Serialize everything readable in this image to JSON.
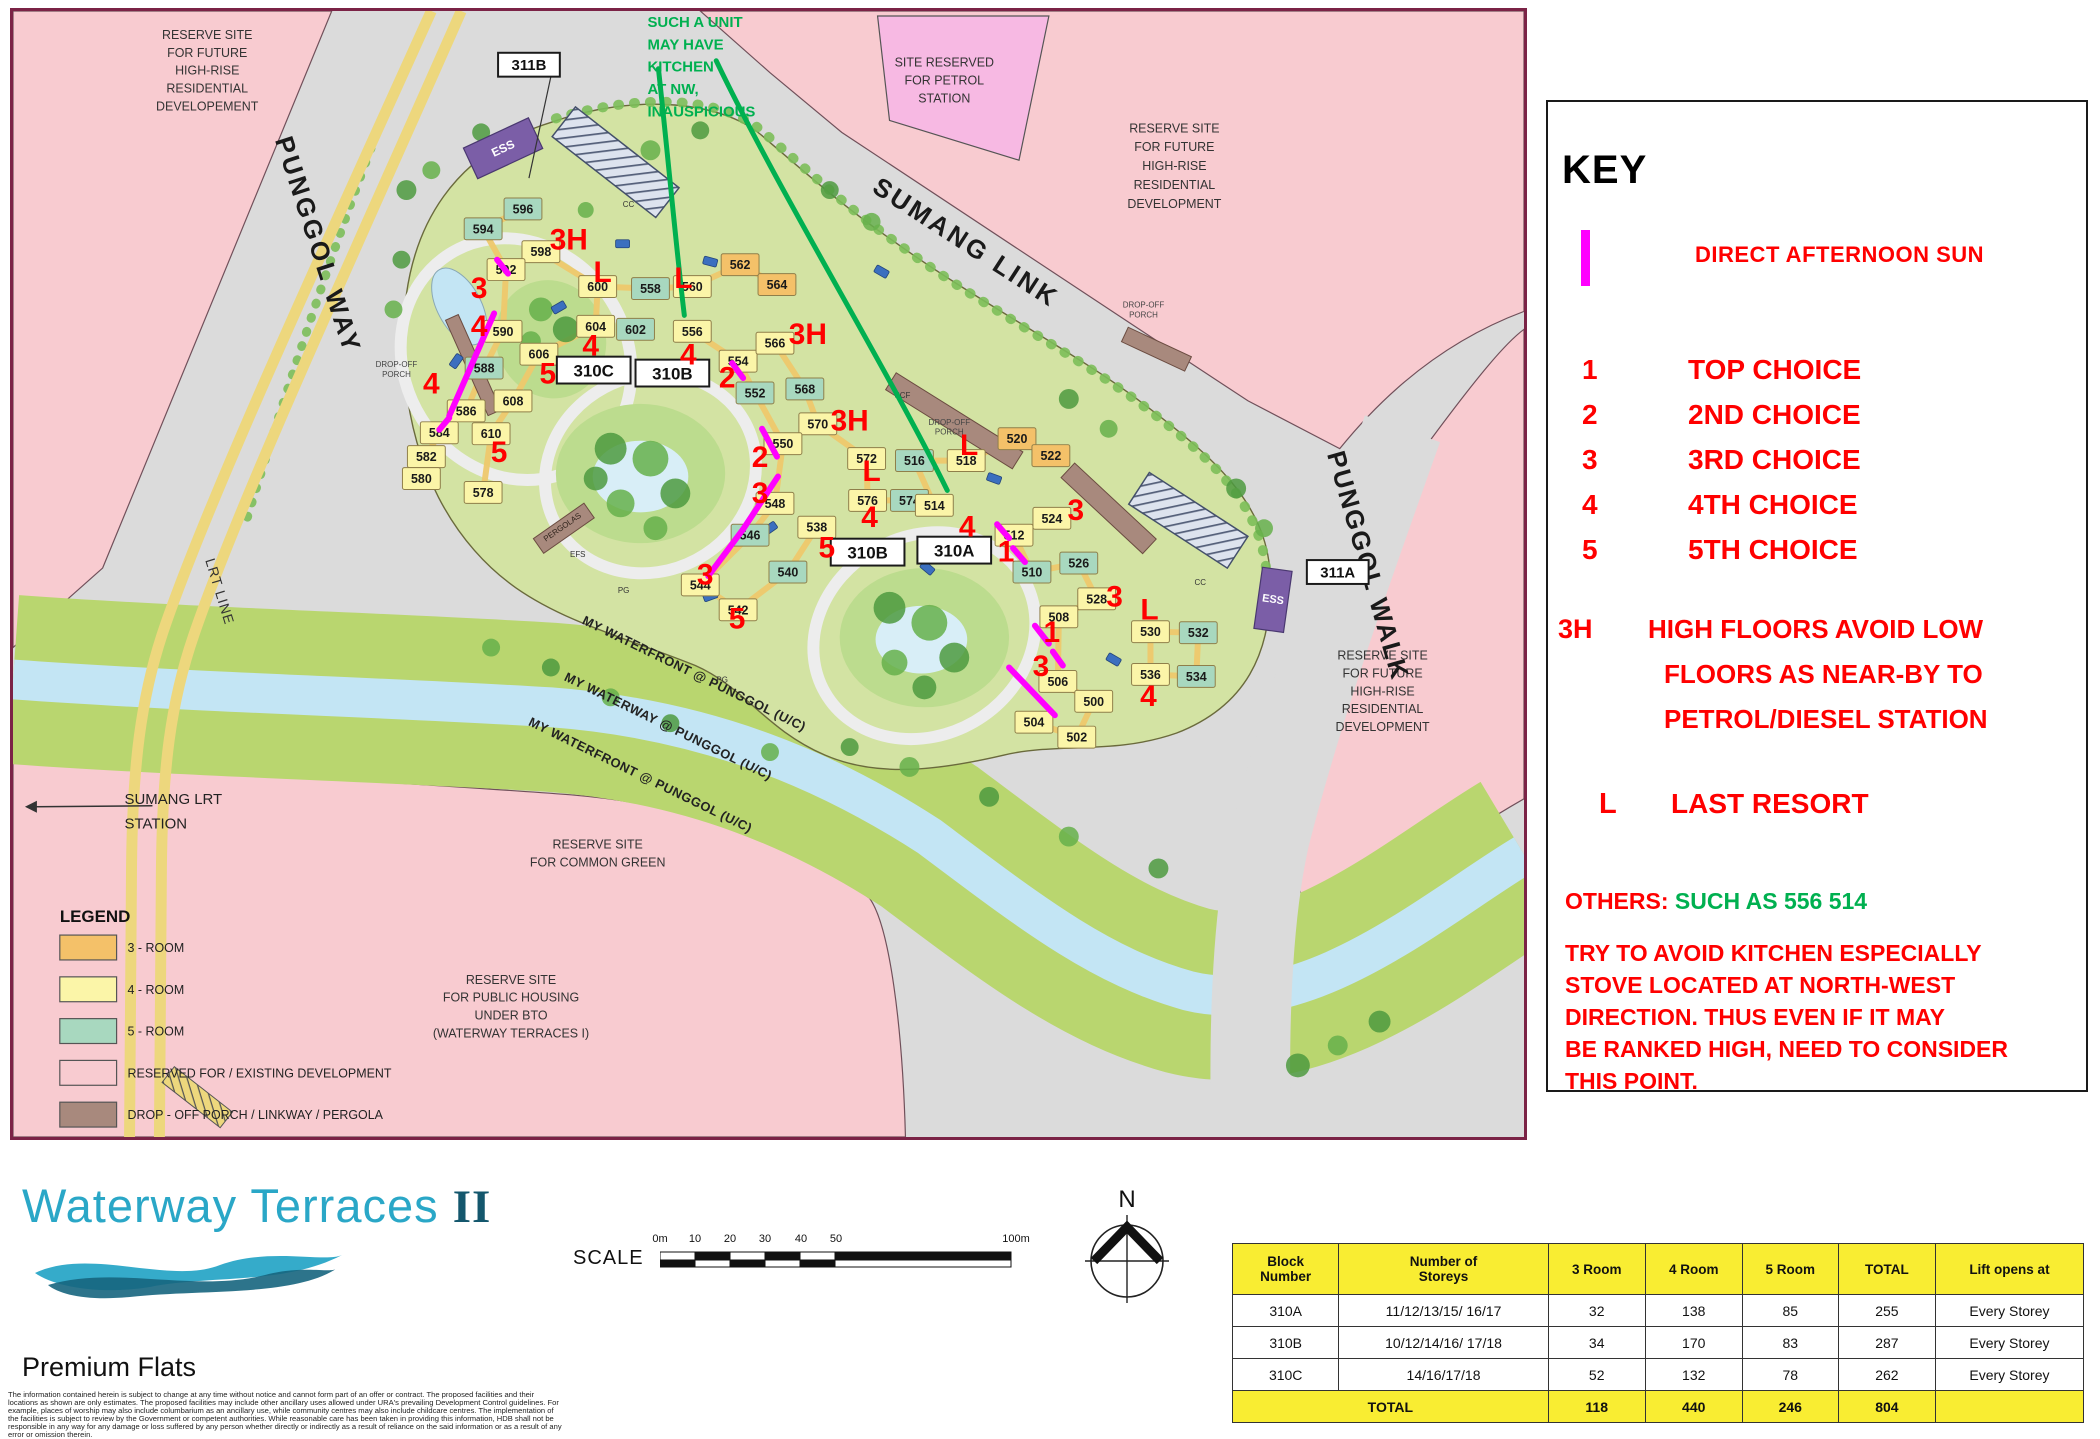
{
  "colors": {
    "red": "#FF0000",
    "magenta": "#FF00FF",
    "green": "#00B050",
    "room3": "#F4C169",
    "room4": "#FBF5A8",
    "room5": "#A8D8BF",
    "reserved": "#F8CBD0",
    "porch": "#A8897D",
    "header_yellow": "#F9ED32",
    "logo_teal": "#2AA7C7"
  },
  "map": {
    "green_note": {
      "x": 637,
      "y": 16,
      "lh": 22.5,
      "size": 15,
      "lines": [
        "SUCH A UNIT",
        "MAY HAVE",
        "KITCHEN",
        "AT NW,",
        "INAUSPICIOUS"
      ]
    },
    "texts": [
      {
        "id": "reserve-tl",
        "lines": [
          "RESERVE SITE",
          "FOR FUTURE",
          "HIGH-RISE",
          "RESIDENTIAL",
          "DEVELOPEMENT"
        ],
        "x": 195,
        "y": 28,
        "lh": 18,
        "size": 12.5,
        "anchor": "middle",
        "color": "#333",
        "weight": 400,
        "rot": 0,
        "ls": 0
      },
      {
        "id": "reserve-tr",
        "lines": [
          "RESERVE SITE",
          "FOR FUTURE",
          "HIGH-RISE",
          "RESIDENTIAL",
          "DEVELOPMENT"
        ],
        "x": 1166,
        "y": 122,
        "lh": 19,
        "size": 12.5,
        "anchor": "middle",
        "color": "#333",
        "weight": 400,
        "rot": 0,
        "ls": 0
      },
      {
        "id": "reserve-br",
        "lines": [
          "RESERVE SITE",
          "FOR FUTURE",
          "HIGH-RISE",
          "RESIDENTIAL",
          "DEVELOPMENT"
        ],
        "x": 1375,
        "y": 652,
        "lh": 18,
        "size": 12.5,
        "anchor": "middle",
        "color": "#333",
        "weight": 400,
        "rot": 0,
        "ls": 0
      },
      {
        "id": "petrol-site",
        "lines": [
          "SITE RESERVED",
          "FOR PETROL",
          "STATION"
        ],
        "x": 935,
        "y": 56,
        "lh": 18,
        "size": 12.5,
        "anchor": "middle",
        "color": "#333",
        "weight": 400,
        "rot": 0,
        "ls": 0
      },
      {
        "id": "common-green",
        "lines": [
          "RESERVE SITE",
          "FOR COMMON GREEN"
        ],
        "x": 587,
        "y": 842,
        "lh": 18,
        "size": 12.5,
        "anchor": "middle",
        "color": "#333",
        "weight": 400,
        "rot": 0,
        "ls": 0
      },
      {
        "id": "public-housing",
        "lines": [
          "RESERVE SITE",
          "FOR PUBLIC HOUSING",
          "UNDER BTO",
          "(WATERWAY TERRACES I)"
        ],
        "x": 500,
        "y": 978,
        "lh": 18,
        "size": 12.5,
        "anchor": "middle",
        "color": "#333",
        "weight": 400,
        "rot": 0,
        "ls": 0
      },
      {
        "id": "sumang-station",
        "lines": [
          "SUMANG LRT",
          "STATION"
        ],
        "x": 112,
        "y": 797,
        "lh": 25,
        "size": 15,
        "anchor": "start",
        "color": "#222",
        "weight": 400,
        "rot": 0,
        "ls": 0
      },
      {
        "id": "punggol-way",
        "lines": [
          "PUNGGOL WAY"
        ],
        "x": 298,
        "y": 238,
        "lh": 0,
        "size": 26,
        "anchor": "middle",
        "color": "#1a1a1a",
        "weight": 700,
        "rot": 72,
        "ls": 3
      },
      {
        "id": "lrt-line",
        "lines": [
          "LRT LINE"
        ],
        "x": 203,
        "y": 585,
        "lh": 0,
        "size": 14,
        "anchor": "middle",
        "color": "#333",
        "weight": 400,
        "rot": 73,
        "ls": 1
      },
      {
        "id": "sumang-link",
        "lines": [
          "SUMANG LINK"
        ],
        "x": 952,
        "y": 240,
        "lh": 0,
        "size": 26,
        "anchor": "middle",
        "color": "#1a1a1a",
        "weight": 700,
        "rot": 33,
        "ls": 3
      },
      {
        "id": "punggol-walk",
        "lines": [
          "PUNGGOL WALK"
        ],
        "x": 1352,
        "y": 560,
        "lh": 0,
        "size": 26,
        "anchor": "middle",
        "color": "#1a1a1a",
        "weight": 700,
        "rot": 74,
        "ls": 2
      },
      {
        "id": "waterfront-1",
        "lines": [
          "MY WATERFRONT @ PUNGGOL (U/C)"
        ],
        "x": 682,
        "y": 670,
        "lh": 0,
        "size": 13,
        "anchor": "middle",
        "color": "#222",
        "weight": 700,
        "rot": 26,
        "ls": 0.5
      },
      {
        "id": "waterway",
        "lines": [
          "MY WATERWAY @ PUNGGOL (U/C)"
        ],
        "x": 656,
        "y": 723,
        "lh": 0,
        "size": 13,
        "anchor": "middle",
        "color": "#222",
        "weight": 700,
        "rot": 26,
        "ls": 0.5
      },
      {
        "id": "waterfront-2",
        "lines": [
          "MY WATERFRONT @ PUNGGOL (U/C)"
        ],
        "x": 628,
        "y": 772,
        "lh": 0,
        "size": 13,
        "anchor": "middle",
        "color": "#222",
        "weight": 700,
        "rot": 26,
        "ls": 0.5
      },
      {
        "id": "dropoff-1",
        "lines": [
          "DROP-OFF",
          "PORCH"
        ],
        "x": 385,
        "y": 358,
        "lh": 10,
        "size": 8,
        "anchor": "middle",
        "color": "#444",
        "weight": 400,
        "rot": 0,
        "ls": 0
      },
      {
        "id": "dropoff-2",
        "lines": [
          "DROP-OFF",
          "PORCH"
        ],
        "x": 940,
        "y": 416,
        "lh": 10,
        "size": 8,
        "anchor": "middle",
        "color": "#444",
        "weight": 400,
        "rot": 0,
        "ls": 0
      },
      {
        "id": "dropoff-3",
        "lines": [
          "DROP-OFF",
          "PORCH"
        ],
        "x": 1135,
        "y": 298,
        "lh": 10,
        "size": 8,
        "anchor": "middle",
        "color": "#444",
        "weight": 400,
        "rot": 0,
        "ls": 0
      },
      {
        "id": "pergolas",
        "lines": [
          "PERGOLAS"
        ],
        "x": 553,
        "y": 521,
        "lh": 0,
        "size": 8,
        "anchor": "middle",
        "color": "#30241c",
        "weight": 400,
        "rot": -35,
        "ls": 0
      },
      {
        "id": "efs",
        "lines": [
          "EFS"
        ],
        "x": 567,
        "y": 549,
        "lh": 0,
        "size": 8,
        "anchor": "middle",
        "color": "#333",
        "weight": 400,
        "rot": 0,
        "ls": 0
      },
      {
        "id": "pg-1",
        "lines": [
          "PG"
        ],
        "x": 613,
        "y": 585,
        "lh": 0,
        "size": 8,
        "anchor": "middle",
        "color": "#333",
        "weight": 400,
        "rot": 0,
        "ls": 0
      },
      {
        "id": "pg-2",
        "lines": [
          "PG"
        ],
        "x": 712,
        "y": 675,
        "lh": 0,
        "size": 8,
        "anchor": "middle",
        "color": "#333",
        "weight": 400,
        "rot": 0,
        "ls": 0
      },
      {
        "id": "cc-1",
        "lines": [
          "CC"
        ],
        "x": 618,
        "y": 197,
        "lh": 0,
        "size": 8,
        "anchor": "middle",
        "color": "#333",
        "weight": 400,
        "rot": 0,
        "ls": 0
      },
      {
        "id": "cc-2",
        "lines": [
          "CC"
        ],
        "x": 1192,
        "y": 577,
        "lh": 0,
        "size": 8,
        "anchor": "middle",
        "color": "#333",
        "weight": 400,
        "rot": 0,
        "ls": 0
      },
      {
        "id": "scf",
        "lines": [
          "SCF"
        ],
        "x": 893,
        "y": 389,
        "lh": 0,
        "size": 8,
        "anchor": "middle",
        "color": "#333",
        "weight": 400,
        "rot": 0,
        "ls": 0
      }
    ],
    "ess_label": "ESS",
    "road_tags": [
      {
        "label": "311B",
        "x": 518,
        "y": 54
      },
      {
        "label": "311A",
        "x": 1330,
        "y": 564
      }
    ],
    "block_tags": [
      {
        "label": "310C",
        "x": 583,
        "y": 361
      },
      {
        "label": "310B",
        "x": 662,
        "y": 364
      },
      {
        "label": "310B",
        "x": 858,
        "y": 544
      },
      {
        "label": "310A",
        "x": 945,
        "y": 542
      }
    ],
    "blocks": [
      [
        "596",
        5,
        512,
        199
      ],
      [
        "594",
        5,
        472,
        219
      ],
      [
        "598",
        4,
        530,
        242
      ],
      [
        "592",
        4,
        495,
        260
      ],
      [
        "600",
        4,
        587,
        277
      ],
      [
        "558",
        5,
        640,
        279
      ],
      [
        "560",
        4,
        682,
        277
      ],
      [
        "562",
        3,
        730,
        255
      ],
      [
        "564",
        3,
        767,
        275
      ],
      [
        "602",
        5,
        625,
        320
      ],
      [
        "604",
        4,
        585,
        317
      ],
      [
        "556",
        4,
        682,
        322
      ],
      [
        "554",
        4,
        728,
        352
      ],
      [
        "566",
        4,
        765,
        334
      ],
      [
        "568",
        5,
        795,
        380
      ],
      [
        "570",
        4,
        808,
        415
      ],
      [
        "552",
        5,
        745,
        384
      ],
      [
        "550",
        4,
        773,
        435
      ],
      [
        "590",
        4,
        492,
        322
      ],
      [
        "606",
        4,
        528,
        345
      ],
      [
        "588",
        5,
        473,
        359
      ],
      [
        "608",
        4,
        502,
        392
      ],
      [
        "610",
        4,
        480,
        425
      ],
      [
        "586",
        4,
        455,
        402
      ],
      [
        "584",
        4,
        428,
        424
      ],
      [
        "582",
        4,
        415,
        448
      ],
      [
        "580",
        4,
        410,
        470
      ],
      [
        "578",
        4,
        472,
        484
      ],
      [
        "548",
        4,
        765,
        495
      ],
      [
        "546",
        5,
        740,
        527
      ],
      [
        "544",
        4,
        690,
        577
      ],
      [
        "542",
        4,
        728,
        602
      ],
      [
        "540",
        5,
        778,
        564
      ],
      [
        "538",
        4,
        807,
        519
      ],
      [
        "572",
        4,
        857,
        450
      ],
      [
        "516",
        5,
        905,
        452
      ],
      [
        "518",
        4,
        957,
        452
      ],
      [
        "520",
        3,
        1008,
        430
      ],
      [
        "522",
        3,
        1042,
        447
      ],
      [
        "576",
        4,
        858,
        492
      ],
      [
        "574",
        5,
        900,
        492
      ],
      [
        "514",
        4,
        925,
        497
      ],
      [
        "524",
        4,
        1043,
        510
      ],
      [
        "512",
        4,
        1005,
        527
      ],
      [
        "510",
        5,
        1023,
        564
      ],
      [
        "526",
        5,
        1070,
        555
      ],
      [
        "528",
        4,
        1088,
        591
      ],
      [
        "508",
        4,
        1050,
        609
      ],
      [
        "506",
        4,
        1049,
        674
      ],
      [
        "500",
        4,
        1085,
        694
      ],
      [
        "502",
        4,
        1068,
        730
      ],
      [
        "504",
        4,
        1025,
        715
      ],
      [
        "530",
        4,
        1142,
        624
      ],
      [
        "532",
        5,
        1190,
        625
      ],
      [
        "534",
        5,
        1188,
        669
      ],
      [
        "536",
        4,
        1142,
        667
      ]
    ],
    "annotations": [
      [
        "3H",
        558,
        230
      ],
      [
        "L",
        592,
        263
      ],
      [
        "L",
        673,
        269
      ],
      [
        "3",
        468,
        279
      ],
      [
        "4",
        468,
        317
      ],
      [
        "4",
        420,
        375
      ],
      [
        "5",
        537,
        365
      ],
      [
        "5",
        488,
        444
      ],
      [
        "4",
        580,
        337
      ],
      [
        "4",
        678,
        346
      ],
      [
        "3H",
        798,
        325
      ],
      [
        "2",
        717,
        369
      ],
      [
        "2",
        750,
        449
      ],
      [
        "3H",
        840,
        412
      ],
      [
        "L",
        862,
        463
      ],
      [
        "L",
        960,
        437
      ],
      [
        "3",
        750,
        485
      ],
      [
        "3",
        695,
        567
      ],
      [
        "5",
        817,
        540
      ],
      [
        "5",
        727,
        611
      ],
      [
        "4",
        860,
        509
      ],
      [
        "4",
        958,
        519
      ],
      [
        "1",
        997,
        544
      ],
      [
        "1",
        1043,
        625
      ],
      [
        "3",
        1067,
        502
      ],
      [
        "3",
        1106,
        589
      ],
      [
        "3",
        1032,
        659
      ],
      [
        "L",
        1141,
        602
      ],
      [
        "4",
        1140,
        689
      ]
    ],
    "sun_lines": [
      [
        486,
        250,
        497,
        264
      ],
      [
        483,
        304,
        438,
        407
      ],
      [
        438,
        409,
        428,
        421
      ],
      [
        722,
        354,
        733,
        369
      ],
      [
        752,
        420,
        767,
        448
      ],
      [
        768,
        468,
        733,
        521
      ],
      [
        733,
        521,
        698,
        568
      ],
      [
        988,
        516,
        1000,
        530
      ],
      [
        1004,
        540,
        1016,
        554
      ],
      [
        1026,
        618,
        1040,
        636
      ],
      [
        1044,
        644,
        1054,
        658
      ],
      [
        1000,
        660,
        1046,
        708
      ]
    ],
    "green_lines": [
      "M648,58 C658,150 666,240 674,306",
      "M706,50 C768,180 878,360 938,482"
    ],
    "legend": {
      "title": "LEGEND",
      "items": [
        {
          "label": "3 - ROOM",
          "color": "#F4C169"
        },
        {
          "label": "4 - ROOM",
          "color": "#FBF5A8"
        },
        {
          "label": "5 - ROOM",
          "color": "#A8D8BF"
        },
        {
          "label": "RESERVED FOR / EXISTING DEVELOPMENT",
          "color": "#F8CBD0"
        },
        {
          "label": "DROP - OFF PORCH / LINKWAY / PERGOLA",
          "color": "#A8897D"
        }
      ]
    }
  },
  "key_panel": {
    "title": "KEY",
    "sun_label": "DIRECT AFTERNOON SUN",
    "choices": [
      {
        "n": "1",
        "label": "TOP CHOICE"
      },
      {
        "n": "2",
        "label": "2ND CHOICE"
      },
      {
        "n": "3",
        "label": "3RD CHOICE"
      },
      {
        "n": "4",
        "label": "4TH CHOICE"
      },
      {
        "n": "5",
        "label": "5TH CHOICE"
      }
    ],
    "h3": {
      "sym": "3H",
      "lines": [
        "HIGH FLOORS AVOID LOW",
        "FLOORS AS NEAR-BY TO",
        "PETROL/DIESEL STATION"
      ]
    },
    "last": {
      "sym": "L",
      "label": "LAST RESORT"
    },
    "others": {
      "prefix": "OTHERS: ",
      "highlight": "SUCH AS 556 514",
      "lines": [
        "TRY TO AVOID KITCHEN ESPECIALLY",
        "STOVE LOCATED AT NORTH-WEST",
        "DIRECTION. THUS EVEN IF IT MAY",
        "BE RANKED HIGH, NEED TO CONSIDER",
        "THIS POINT."
      ]
    }
  },
  "footer": {
    "logo_main": "Waterway Terraces ",
    "logo_suffix": "II",
    "subtitle": "Premium Flats",
    "scale_label": "SCALE",
    "scale_ticks": [
      "0m",
      "10",
      "20",
      "30",
      "40",
      "50",
      "100m"
    ],
    "compass_n": "N",
    "disclaimer": [
      "The information contained herein is subject to change at any time without notice and cannot form part of an offer or contract. The proposed facilities and their",
      "locations as shown are only estimates. The proposed facilities may include other ancillary uses allowed under URA's prevailing Development Control guidelines. For",
      "example, places of worship may also include columbarium as an ancillary use, while community centres may also include childcare centres. The implementation of",
      "the facilities is subject to review by the Government or competent authorities. While reasonable care has been taken in providing this information, HDB shall not be",
      "responsible in any way for any damage or loss suffered by any person whether directly or indirectly as a result of reliance on the said information or as a result of any",
      "error or omission therein."
    ]
  },
  "table": {
    "headers": [
      "Block\nNumber",
      "Number of\nStoreys",
      "3 Room",
      "4 Room",
      "5 Room",
      "TOTAL",
      "Lift opens at"
    ],
    "rows": [
      [
        "310A",
        "11/12/13/15/ 16/17",
        "32",
        "138",
        "85",
        "255",
        "Every Storey"
      ],
      [
        "310B",
        "10/12/14/16/ 17/18",
        "34",
        "170",
        "83",
        "287",
        "Every Storey"
      ],
      [
        "310C",
        "14/16/17/18",
        "52",
        "132",
        "78",
        "262",
        "Every Storey"
      ]
    ],
    "total_row": {
      "label": "TOTAL",
      "values": [
        "118",
        "440",
        "246",
        "804",
        ""
      ]
    }
  }
}
